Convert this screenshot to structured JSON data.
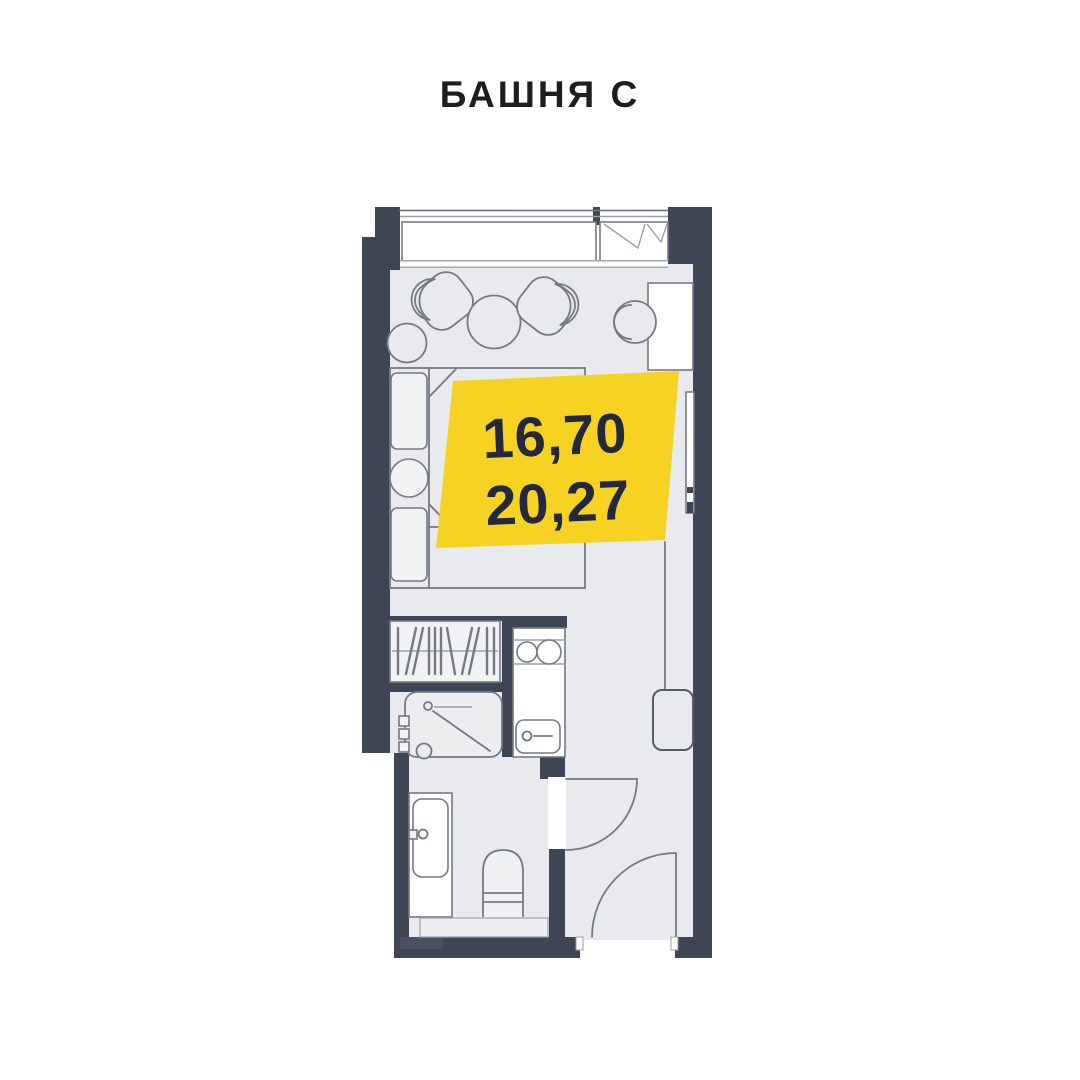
{
  "header": {
    "title": "БАШНЯ С"
  },
  "badge": {
    "area_top": "16,70",
    "area_bottom": "20,27"
  },
  "colors": {
    "accent_yellow": "#F6D322",
    "wall": "#3E4555",
    "floor": "#E9EAED",
    "badge_text": "#23293B",
    "title_text": "#1D1D1F",
    "furniture_stroke": "#747A83",
    "background": "#FFFFFF"
  }
}
